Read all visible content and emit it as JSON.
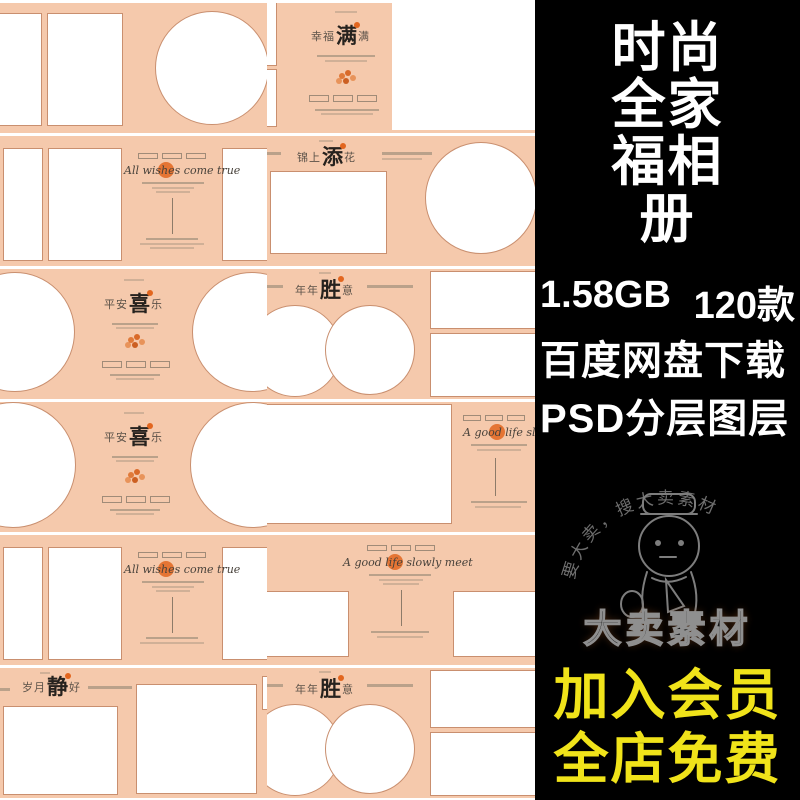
{
  "product": {
    "title_lines": [
      "时尚",
      "全家",
      "福相",
      "册"
    ],
    "file_size": "1.58GB",
    "style_count": "120款",
    "download_line": "百度网盘下载",
    "format_line": "PSD分层图层",
    "promo_lines": [
      "加入会员",
      "全店免费"
    ]
  },
  "watermark": {
    "arc_text": "要大卖，搜大卖素材",
    "brand": "大卖素材"
  },
  "templates": {
    "r1c2_title": {
      "pre": "幸福",
      "big": "满",
      "post": "满"
    },
    "r2c1_title": "All wishes come true",
    "r2c2_title": {
      "pre": "锦上",
      "big": "添",
      "post": "花"
    },
    "r3c1_title": {
      "pre": "平安",
      "big": "喜",
      "post": "乐"
    },
    "r3c2_title": {
      "pre": "年年",
      "big": "胜",
      "post": "意"
    },
    "r4c1_title": {
      "pre": "平安",
      "big": "喜",
      "post": "乐"
    },
    "r4c2_title": "A good life slowly meet",
    "r5c1_title": "All wishes come true",
    "r5c2_title": "A good life slowly meet",
    "r6c1_title": {
      "pre": "岁月",
      "big": "静",
      "post": "好"
    },
    "r6c2_title": {
      "pre": "年年",
      "big": "胜",
      "post": "意"
    }
  },
  "colors": {
    "panel_bg": "#000000",
    "panel_text": "#ffffff",
    "promo_yellow": "#f0e31a",
    "canvas_peach": "#f5c9ac",
    "frame_border": "#c98f6f",
    "accent_orange": "#e2661f"
  }
}
